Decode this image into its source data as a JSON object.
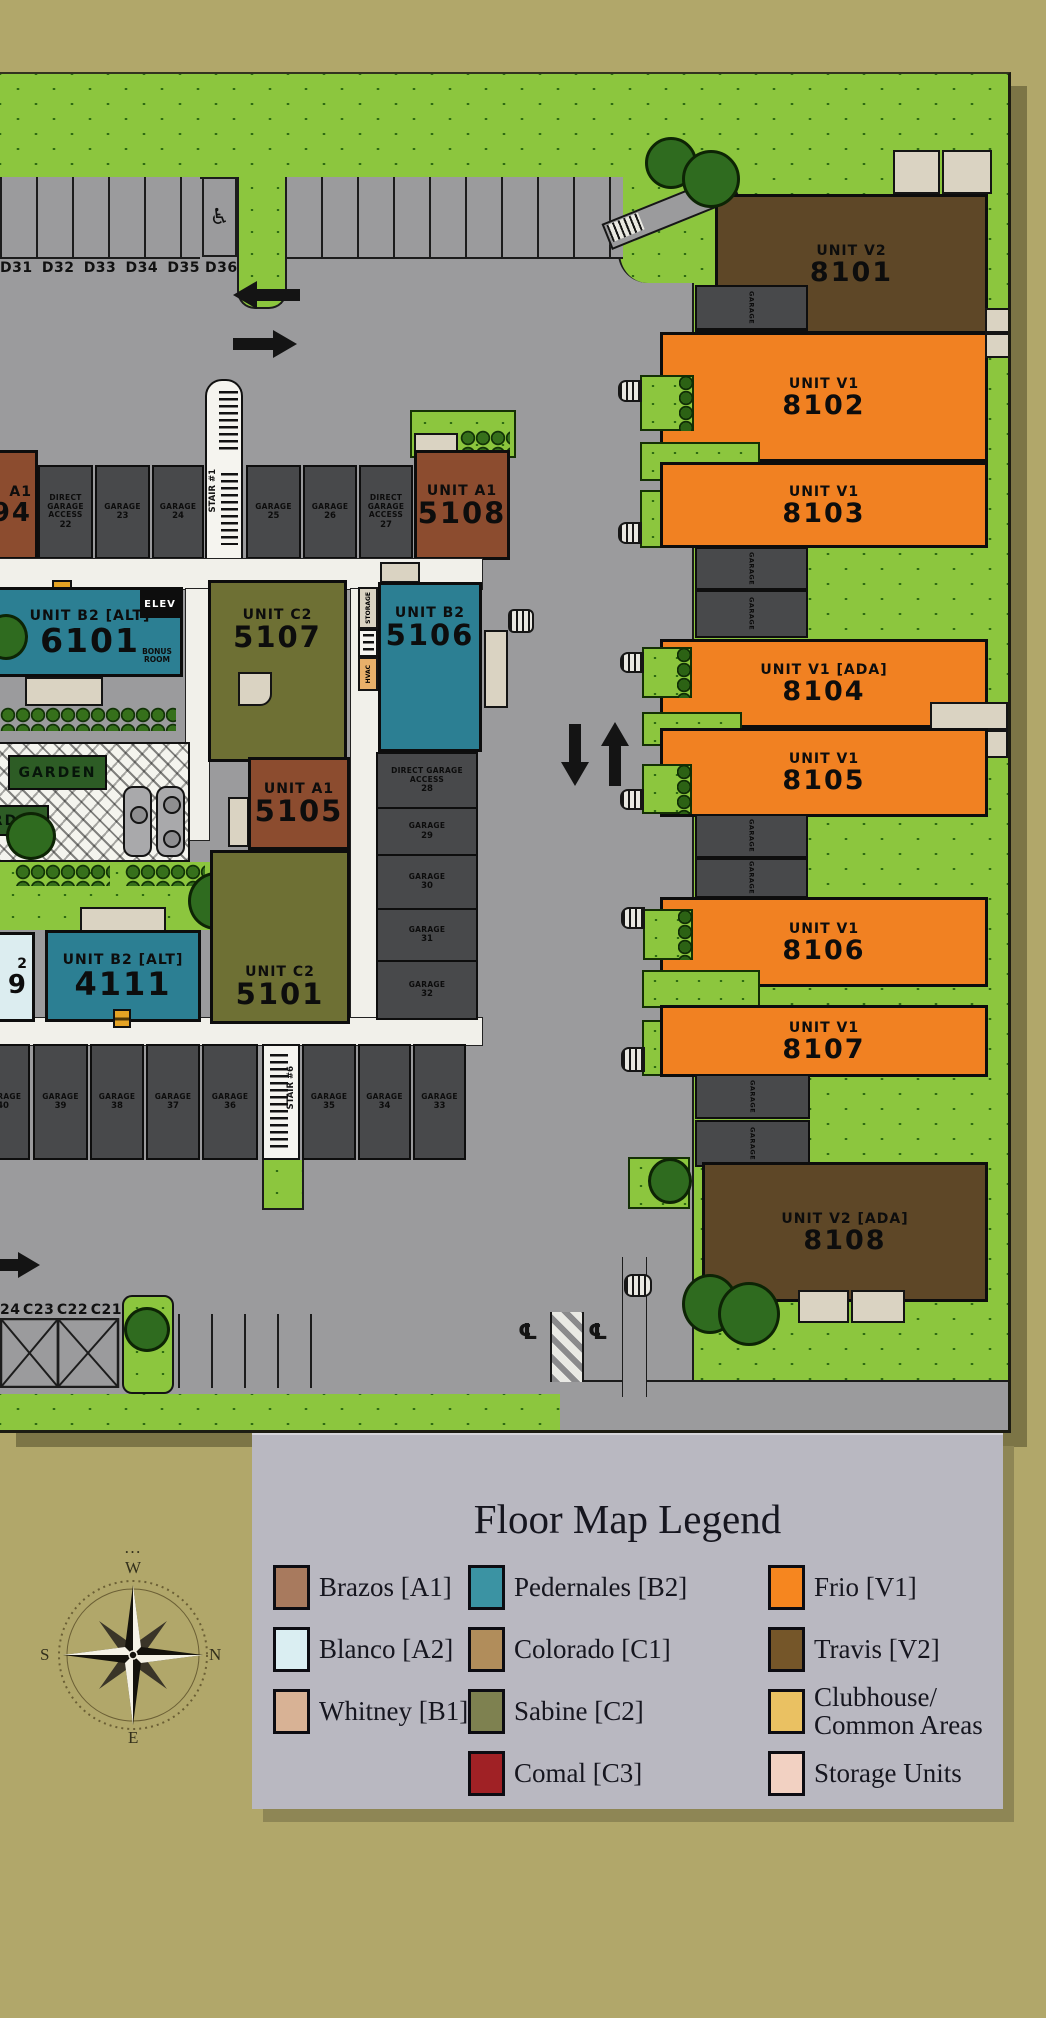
{
  "palette": {
    "khaki": "#b1a76a",
    "grass": "#8cc63e",
    "grassmark": "#2e6b12",
    "road": "#9b9b9d",
    "sidewalk": "#f1f0ea",
    "garage": "#48494b",
    "teal": "#2c7f93",
    "olive": "#6e7034",
    "browna1": "#8c4c2f",
    "brownv2": "#5e4727",
    "orangev1": "#f18122",
    "blanco": "#dcedf0",
    "beige": "#dad3c2",
    "gardengreen": "#2d5c25",
    "hedge": "#36701b",
    "tree": "#2f6b1f",
    "mapshadow": "#7c7546",
    "legendpanel": "#b9b8c1",
    "legendshadow": "#8e8655",
    "ink": "#16161f",
    "markerorange": "#e5a324"
  },
  "map": {
    "parking_row_top": {
      "labels": [
        "D31",
        "D32",
        "D33",
        "D34",
        "D35"
      ],
      "accessible_label": "D36",
      "accessible_icon": "♿"
    },
    "parking_row_bottom": {
      "labels": [
        "24",
        "C23",
        "C22",
        "C21"
      ]
    },
    "left_building": {
      "partial_unit_top": {
        "line1": "A1",
        "line2": "94"
      },
      "stair_top": {
        "label": "STAIR #1"
      },
      "stair_bottom": {
        "label": "STAIR #6"
      },
      "garages_top": [
        {
          "title": "DIRECT GARAGE ACCESS",
          "num": "22"
        },
        {
          "title": "GARAGE",
          "num": "23"
        },
        {
          "title": "GARAGE",
          "num": "24"
        },
        {
          "title": "GARAGE",
          "num": "25"
        },
        {
          "title": "GARAGE",
          "num": "26"
        },
        {
          "title": "DIRECT GARAGE ACCESS",
          "num": "27"
        }
      ],
      "garages_right": [
        {
          "title": "DIRECT GARAGE ACCESS",
          "num": "28"
        },
        {
          "title": "GARAGE",
          "num": "29"
        },
        {
          "title": "GARAGE",
          "num": "30"
        },
        {
          "title": "GARAGE",
          "num": "31"
        },
        {
          "title": "GARAGE",
          "num": "32"
        }
      ],
      "garages_bottom": [
        {
          "title": "GARAGE",
          "num": "40"
        },
        {
          "title": "GARAGE",
          "num": "39"
        },
        {
          "title": "GARAGE",
          "num": "38"
        },
        {
          "title": "GARAGE",
          "num": "37"
        },
        {
          "title": "GARAGE",
          "num": "36"
        },
        {
          "title": "GARAGE",
          "num": "35"
        },
        {
          "title": "GARAGE",
          "num": "34"
        },
        {
          "title": "GARAGE",
          "num": "33"
        }
      ],
      "units": {
        "u5108": {
          "name": "UNIT A1",
          "num": "5108"
        },
        "u6101": {
          "name": "UNIT B2 [ALT]",
          "num": "6101",
          "elev": "ELEV",
          "bonus": "BONUS ROOM"
        },
        "u5107": {
          "name": "UNIT C2",
          "num": "5107"
        },
        "u5106": {
          "name": "UNIT B2",
          "num": "5106",
          "side_storage": "STORAGE",
          "side_hvac": "HVAC"
        },
        "u5105": {
          "name": "UNIT A1",
          "num": "5105"
        },
        "u5101": {
          "name": "UNIT C2",
          "num": "5101"
        },
        "u4111": {
          "name": "UNIT B2 [ALT]",
          "num": "4111"
        },
        "partial_a2": {
          "line1": "2",
          "line2": "9"
        }
      },
      "garden_labels": [
        "GARDEN",
        "GARDEN"
      ]
    },
    "right_building": {
      "garage_label": "GARAGE",
      "units": [
        {
          "name": "UNIT V2",
          "num": "8101"
        },
        {
          "name": "UNIT V1",
          "num": "8102"
        },
        {
          "name": "UNIT V1",
          "num": "8103"
        },
        {
          "name": "UNIT V1 [ADA]",
          "num": "8104"
        },
        {
          "name": "UNIT V1",
          "num": "8105"
        },
        {
          "name": "UNIT V1",
          "num": "8106"
        },
        {
          "name": "UNIT V1",
          "num": "8107"
        },
        {
          "name": "UNIT V2 [ADA]",
          "num": "8108"
        }
      ]
    },
    "centerline_symbol": "℄"
  },
  "legend": {
    "title": "Floor Map Legend",
    "columns": [
      [
        {
          "label": "Brazos [A1]",
          "color": "#a87a5e"
        },
        {
          "label": "Blanco [A2]",
          "color": "#daeef2"
        },
        {
          "label": "Whitney [B1]",
          "color": "#d8b295"
        }
      ],
      [
        {
          "label": "Pedernales [B2]",
          "color": "#3b93a3"
        },
        {
          "label": "Colorado [C1]",
          "color": "#b18d5b"
        },
        {
          "label": "Sabine [C2]",
          "color": "#7e8150"
        },
        {
          "label": "Comal [C3]",
          "color": "#a02125"
        }
      ],
      [
        {
          "label": "Frio [V1]",
          "color": "#f6861f"
        },
        {
          "label": "Travis [V2]",
          "color": "#755629"
        },
        {
          "label": "Clubhouse/\nCommon Areas",
          "color": "#eac162"
        },
        {
          "label": "Storage Units",
          "color": "#f2d1c2"
        }
      ]
    ]
  },
  "compass": {
    "dots": "…",
    "top": "W",
    "right": "N",
    "left": "S",
    "bottom": "E"
  }
}
